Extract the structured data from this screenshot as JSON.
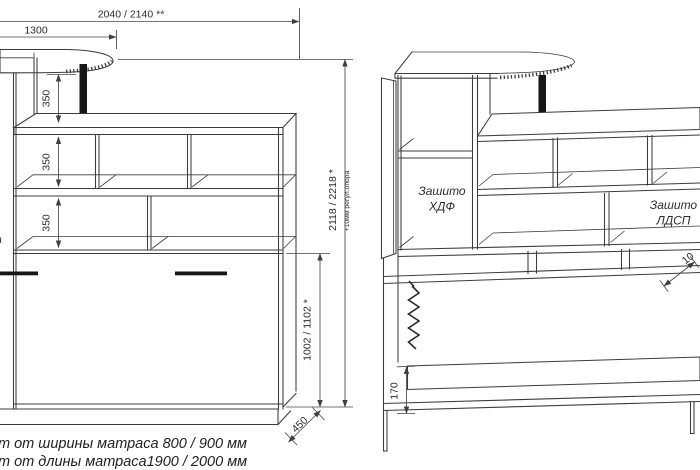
{
  "palette": {
    "bg": "#ffffff",
    "ink": "#3c3c3c",
    "dim_ink": "#464646",
    "black_fill": "#161616"
  },
  "front_view": {
    "dim_total_width": "2040 / 2140 **",
    "dim_bar_length": "1300",
    "dim_shelf_1": "350",
    "dim_shelf_2": "350",
    "dim_shelf_3": "350",
    "dim_bed_height": "1002 / 1102 *",
    "dim_total_height": "2118 / 2218 *",
    "dim_total_height_note": "+10мм регул.опора",
    "dim_depth": "450",
    "clipped_letter": "н"
  },
  "side_view": {
    "label_hdf": [
      "Зашито",
      "ХДФ"
    ],
    "label_ldsp": [
      "Зашито",
      "ЛДСП"
    ],
    "dim_platform_height": "170",
    "dim_clipped": "10"
  },
  "footnotes": {
    "line1": "т от ширины матраса 800 / 900 мм",
    "line2": "т от длины матраса1900 / 2000 мм"
  }
}
